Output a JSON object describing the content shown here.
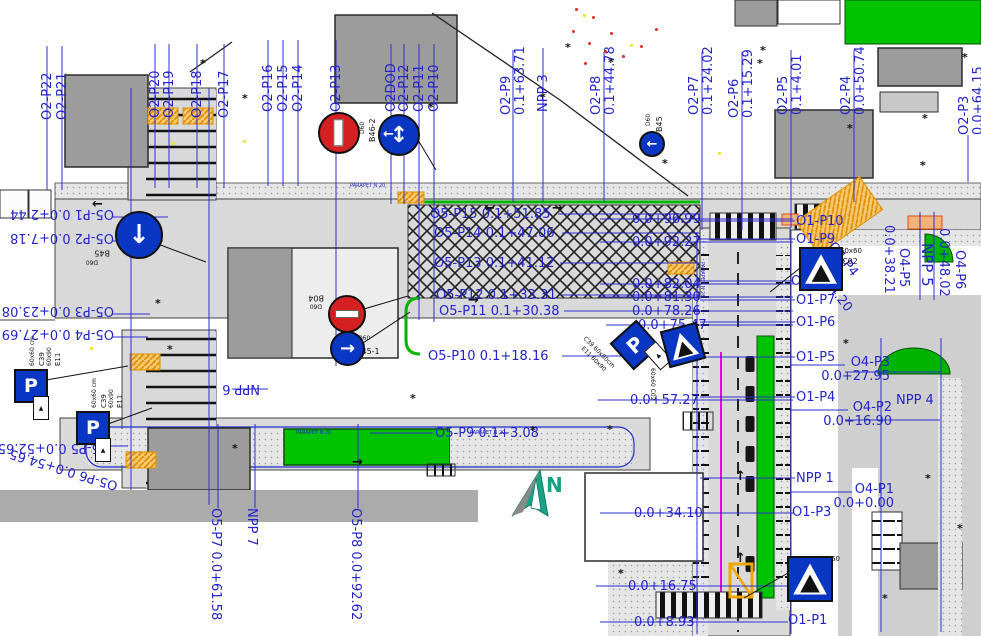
{
  "drawing": {
    "type": "traffic-organization-plan"
  },
  "north": {
    "label": "N"
  },
  "palette": {
    "label_blue": "#2424cc",
    "dimension_blue": "#2f2fd0",
    "green": "#00c300",
    "road_gray": "#d9d9d9",
    "orange": "#f0a000",
    "magenta": "#e800e8",
    "sign_blue": "#0a36c4",
    "sign_red": "#d42020"
  },
  "station_labels": [
    {
      "t": "O2-P22",
      "x": 41,
      "y": 120,
      "r": -90
    },
    {
      "t": "O2-P21",
      "x": 56,
      "y": 120,
      "r": -90
    },
    {
      "t": "O2-P20",
      "x": 149,
      "y": 118,
      "r": -90
    },
    {
      "t": "O2-P19",
      "x": 163,
      "y": 118,
      "r": -90
    },
    {
      "t": "O2-P18",
      "x": 191,
      "y": 118,
      "r": -90
    },
    {
      "t": "O2-P17",
      "x": 218,
      "y": 118,
      "r": -90
    },
    {
      "t": "O2-P16",
      "x": 262,
      "y": 112,
      "r": -90
    },
    {
      "t": "O2-P15",
      "x": 277,
      "y": 112,
      "r": -90
    },
    {
      "t": "O2-P14",
      "x": 292,
      "y": 112,
      "r": -90
    },
    {
      "t": "O2-P13",
      "x": 330,
      "y": 112,
      "r": -90
    },
    {
      "t": "O2DOD",
      "x": 385,
      "y": 112,
      "r": -90
    },
    {
      "t": "O2-P12",
      "x": 398,
      "y": 112,
      "r": -90
    },
    {
      "t": "O2-P11",
      "x": 413,
      "y": 112,
      "r": -90
    },
    {
      "t": "O2-P10",
      "x": 428,
      "y": 112,
      "r": -90
    },
    {
      "t": "O2-P9\n0.1+63.71",
      "x": 500,
      "y": 115,
      "r": -90
    },
    {
      "t": "NPP 3",
      "x": 537,
      "y": 112,
      "r": -90
    },
    {
      "t": "O2-P8\n0.1+44.78",
      "x": 590,
      "y": 115,
      "r": -90
    },
    {
      "t": "O2-P7\n0.1+24.02",
      "x": 688,
      "y": 115,
      "r": -90
    },
    {
      "t": "O2-P6\n0.1+15.29",
      "x": 728,
      "y": 118,
      "r": -90
    },
    {
      "t": "O2-P5\n0.1+4.01",
      "x": 777,
      "y": 115,
      "r": -90
    },
    {
      "t": "O2-P4\n0.0+50.74",
      "x": 840,
      "y": 115,
      "r": -90
    },
    {
      "t": "O2-P3\n0.0+64.15",
      "x": 958,
      "y": 135,
      "r": -90
    },
    {
      "t": "O5-P1 0.0+2.44",
      "x": 2,
      "y": 206,
      "r": 180,
      "w": 112
    },
    {
      "t": "O5-P2 0.0+7.18",
      "x": 2,
      "y": 230,
      "r": 180,
      "w": 112
    },
    {
      "t": "O5-P3 0.0+23.08",
      "x": 2,
      "y": 303,
      "r": 180,
      "w": 112
    },
    {
      "t": "O5-P4 0.0+27.69",
      "x": 2,
      "y": 326,
      "r": 180,
      "w": 112
    },
    {
      "t": "O5-P5 0.0+52.65",
      "x": 0,
      "y": 440,
      "r": 180,
      "w": 110
    },
    {
      "t": "O5-P6 0.0+54.65",
      "x": 8,
      "y": 462,
      "r": 197,
      "w": 112
    },
    {
      "t": "O5-P15 0.1+51.85",
      "x": 430,
      "y": 208
    },
    {
      "t": "O5-P14 0.1+47.06",
      "x": 434,
      "y": 227
    },
    {
      "t": "O5-P13 0.1+41.12",
      "x": 434,
      "y": 257
    },
    {
      "t": "O5-P12 0.1+33.31",
      "x": 436,
      "y": 289
    },
    {
      "t": "O5-P11 0.1+30.38",
      "x": 439,
      "y": 305
    },
    {
      "t": "O5-P10 0.1+18.16",
      "x": 428,
      "y": 350
    },
    {
      "t": "O5-P9 0.1+3.08",
      "x": 435,
      "y": 427
    },
    {
      "t": "0.0+96.99",
      "x": 632,
      "y": 213
    },
    {
      "t": "0.0+92.27",
      "x": 632,
      "y": 236
    },
    {
      "t": "0.0+82.04",
      "x": 632,
      "y": 278
    },
    {
      "t": "0.0+81.30",
      "x": 632,
      "y": 291
    },
    {
      "t": "0.0+78.26",
      "x": 632,
      "y": 305
    },
    {
      "t": "0.0+75.47",
      "x": 638,
      "y": 319
    },
    {
      "t": "0.0+57.27",
      "x": 630,
      "y": 394
    },
    {
      "t": "0.0+34.10",
      "x": 634,
      "y": 507
    },
    {
      "t": "0.0+16.75",
      "x": 628,
      "y": 580
    },
    {
      "t": "0.0+8.93",
      "x": 634,
      "y": 616
    },
    {
      "t": "O1-P10",
      "x": 796,
      "y": 215
    },
    {
      "t": "O1-P9",
      "x": 796,
      "y": 233
    },
    {
      "t": "O1-P8",
      "x": 791,
      "y": 275
    },
    {
      "t": "O1-P7",
      "x": 796,
      "y": 294
    },
    {
      "t": "O1-P6",
      "x": 796,
      "y": 316
    },
    {
      "t": "O1-P5",
      "x": 796,
      "y": 351
    },
    {
      "t": "O1-P4",
      "x": 796,
      "y": 391
    },
    {
      "t": "O4-P2\n0.0+16.90",
      "x": 800,
      "y": 401,
      "w": 92,
      "c": "r"
    },
    {
      "t": "NPP 1",
      "x": 796,
      "y": 472
    },
    {
      "t": "O4-P1\n0.0+0.00",
      "x": 808,
      "y": 483,
      "w": 86,
      "c": "r"
    },
    {
      "t": "O1-P3",
      "x": 792,
      "y": 506
    },
    {
      "t": "O1-P2",
      "x": 790,
      "y": 579
    },
    {
      "t": "O1-P1",
      "x": 788,
      "y": 614
    },
    {
      "t": "O4-P3\n0.0+27.95",
      "x": 798,
      "y": 356,
      "w": 92,
      "c": "r"
    },
    {
      "t": "NPP 4",
      "x": 896,
      "y": 394
    },
    {
      "t": "NPP 6",
      "x": 210,
      "y": 381,
      "r": 180,
      "w": 50
    },
    {
      "t": "O5-P7 0.0+61.58",
      "x": 222,
      "y": 508,
      "r": 90
    },
    {
      "t": "NPP 7",
      "x": 258,
      "y": 508,
      "r": 90
    },
    {
      "t": "O5-P8 0.0+92.62",
      "x": 362,
      "y": 508,
      "r": 90
    },
    {
      "t": "0.0+38.21",
      "x": 895,
      "y": 225,
      "r": 90
    },
    {
      "t": "O4-P5",
      "x": 910,
      "y": 248,
      "r": 90
    },
    {
      "t": "NPP 5",
      "x": 934,
      "y": 243,
      "r": 90,
      "s": 15
    },
    {
      "t": "0.0+48.02",
      "x": 950,
      "y": 228,
      "r": 90
    },
    {
      "t": "O4-P6",
      "x": 966,
      "y": 250,
      "r": 90
    },
    {
      "t": "O4-P4",
      "x": 836,
      "y": 240,
      "r": 52
    },
    {
      "t": "0.0+34.20",
      "x": 812,
      "y": 252,
      "r": 52
    }
  ],
  "micro_labels": [
    {
      "t": "B46-2",
      "x": 369,
      "y": 142,
      "r": -90,
      "s": 8,
      "c": "k"
    },
    {
      "t": "D60",
      "x": 360,
      "y": 134,
      "r": -90,
      "s": 6,
      "c": "k"
    },
    {
      "t": "D60",
      "x": 646,
      "y": 126,
      "r": -90,
      "s": 6,
      "c": "k"
    },
    {
      "t": "B45",
      "x": 656,
      "y": 132,
      "r": -90,
      "s": 8,
      "c": "k"
    },
    {
      "t": "B04",
      "x": 304,
      "y": 293,
      "r": 180,
      "s": 8,
      "c": "k",
      "w": 20
    },
    {
      "t": "D60",
      "x": 306,
      "y": 302,
      "r": 180,
      "s": 6,
      "c": "k",
      "w": 16
    },
    {
      "t": "D60",
      "x": 358,
      "y": 336,
      "s": 6,
      "c": "k"
    },
    {
      "t": "B45-1",
      "x": 356,
      "y": 348,
      "s": 8,
      "c": "k"
    },
    {
      "t": "B45",
      "x": 90,
      "y": 248,
      "r": 180,
      "s": 8,
      "c": "k",
      "w": 20
    },
    {
      "t": "D60",
      "x": 82,
      "y": 258,
      "r": 180,
      "s": 6,
      "c": "k",
      "w": 16
    },
    {
      "t": "60x60 cm",
      "x": 30,
      "y": 366,
      "r": -90,
      "s": 6,
      "c": "k"
    },
    {
      "t": "C39",
      "x": 39,
      "y": 366,
      "r": -90,
      "s": 7,
      "c": "k"
    },
    {
      "t": "60x90",
      "x": 47,
      "y": 366,
      "r": -90,
      "s": 6,
      "c": "k"
    },
    {
      "t": "E11",
      "x": 55,
      "y": 366,
      "r": -90,
      "s": 7,
      "c": "k"
    },
    {
      "t": "60x60 cm",
      "x": 92,
      "y": 408,
      "r": -90,
      "s": 6,
      "c": "k"
    },
    {
      "t": "C39",
      "x": 101,
      "y": 408,
      "r": -90,
      "s": 7,
      "c": "k"
    },
    {
      "t": "60x90",
      "x": 109,
      "y": 408,
      "r": -90,
      "s": 6,
      "c": "k"
    },
    {
      "t": "E11",
      "x": 117,
      "y": 408,
      "r": -90,
      "s": 7,
      "c": "k"
    },
    {
      "t": "C39 60x60cm",
      "x": 586,
      "y": 336,
      "r": 45,
      "s": 6,
      "c": "k"
    },
    {
      "t": "E11 60x90",
      "x": 584,
      "y": 346,
      "r": 45,
      "s": 6,
      "c": "k"
    },
    {
      "t": "60x60",
      "x": 840,
      "y": 248,
      "s": 7,
      "c": "k"
    },
    {
      "t": "C02",
      "x": 842,
      "y": 258,
      "s": 8,
      "c": "k"
    },
    {
      "t": "60x60",
      "x": 818,
      "y": 556,
      "s": 7,
      "c": "k"
    },
    {
      "t": "C02",
      "x": 818,
      "y": 566,
      "s": 8,
      "c": "k"
    },
    {
      "t": "60x60 C02",
      "x": 655,
      "y": 368,
      "r": 90,
      "s": 6,
      "c": "k"
    },
    {
      "t": "PARAPET N 20",
      "x": 350,
      "y": 184,
      "s": 5,
      "c": "m"
    },
    {
      "t": "PARAPET N 20",
      "x": 296,
      "y": 431,
      "s": 5,
      "c": "m"
    },
    {
      "t": "PARAPET N 20",
      "x": 470,
      "y": 431,
      "s": 5,
      "c": "m"
    },
    {
      "t": "PARAPET N 26",
      "x": 704,
      "y": 262,
      "r": 90,
      "s": 5,
      "c": "m"
    }
  ],
  "road_markings": {
    "arrows": [
      {
        "t": "←",
        "x": 92,
        "y": 198
      },
      {
        "t": "←",
        "x": 484,
        "y": 202
      },
      {
        "t": "→",
        "x": 552,
        "y": 202
      },
      {
        "t": "→",
        "x": 468,
        "y": 294
      },
      {
        "t": "→",
        "x": 352,
        "y": 456
      },
      {
        "t": "↑",
        "x": 735,
        "y": 552
      },
      {
        "t": "↑",
        "x": 735,
        "y": 470
      }
    ]
  },
  "signs": [
    {
      "kind": "no-entry",
      "x": 318,
      "y": 112,
      "d": 38,
      "bar": "v",
      "name": "no-entry-sign-b04-top"
    },
    {
      "kind": "arrow-circle",
      "x": 378,
      "y": 114,
      "d": 38,
      "arrow": "updown-left",
      "name": "direction-sign-b46-2"
    },
    {
      "kind": "arrow-circle",
      "x": 115,
      "y": 211,
      "d": 44,
      "arrow": "down",
      "name": "direction-sign-b45-left"
    },
    {
      "kind": "no-entry",
      "x": 328,
      "y": 295,
      "d": 34,
      "bar": "h",
      "name": "no-entry-sign-b04"
    },
    {
      "kind": "arrow-circle",
      "x": 330,
      "y": 331,
      "d": 31,
      "arrow": "right",
      "name": "direction-sign-b45-1"
    },
    {
      "kind": "arrow-circle",
      "x": 639,
      "y": 131,
      "d": 22,
      "arrow": "left",
      "name": "direction-sign-b45-top"
    },
    {
      "kind": "parking",
      "x": 14,
      "y": 369,
      "s": 30,
      "rot": 0,
      "name": "parking-sign-c39-1"
    },
    {
      "kind": "parking",
      "x": 76,
      "y": 411,
      "s": 30,
      "rot": 0,
      "name": "parking-sign-c39-2"
    },
    {
      "kind": "parking",
      "x": 617,
      "y": 327,
      "s": 32,
      "rot": -42,
      "name": "parking-sign-c39-3"
    },
    {
      "kind": "cross",
      "x": 664,
      "y": 326,
      "s": 34,
      "rot": -15,
      "name": "crossing-sign-c02-1"
    },
    {
      "kind": "cross",
      "x": 799,
      "y": 247,
      "s": 40,
      "rot": 0,
      "name": "crossing-sign-c02-2"
    },
    {
      "kind": "cross",
      "x": 787,
      "y": 556,
      "s": 42,
      "rot": 0,
      "name": "crossing-sign-c02-3"
    }
  ],
  "dimension_lines": [
    [
      47,
      46,
      47,
      190
    ],
    [
      62,
      46,
      62,
      190
    ],
    [
      155,
      44,
      155,
      188
    ],
    [
      169,
      44,
      169,
      188
    ],
    [
      197,
      44,
      197,
      188
    ],
    [
      224,
      44,
      224,
      188
    ],
    [
      268,
      40,
      268,
      186
    ],
    [
      283,
      40,
      283,
      186
    ],
    [
      298,
      40,
      298,
      186
    ],
    [
      336,
      40,
      336,
      366
    ],
    [
      391,
      44,
      391,
      204
    ],
    [
      404,
      44,
      404,
      204
    ],
    [
      419,
      44,
      419,
      320
    ],
    [
      434,
      44,
      434,
      322
    ],
    [
      513,
      50,
      513,
      202
    ],
    [
      543,
      48,
      543,
      202
    ],
    [
      604,
      52,
      604,
      202
    ],
    [
      702,
      52,
      702,
      230
    ],
    [
      742,
      52,
      742,
      230
    ],
    [
      791,
      50,
      791,
      228
    ],
    [
      854,
      50,
      854,
      202
    ],
    [
      968,
      135,
      968,
      182
    ],
    [
      131,
      88,
      131,
      490
    ],
    [
      209,
      88,
      209,
      505
    ],
    [
      697,
      232,
      697,
      634
    ],
    [
      791,
      230,
      791,
      634
    ],
    [
      881,
      338,
      881,
      632
    ],
    [
      941,
      338,
      941,
      632
    ],
    [
      920,
      212,
      920,
      300
    ],
    [
      934,
      212,
      934,
      300
    ],
    [
      218,
      424,
      218,
      508
    ],
    [
      255,
      424,
      255,
      508
    ],
    [
      358,
      424,
      358,
      508
    ],
    [
      112,
      217,
      168,
      217
    ],
    [
      112,
      241,
      163,
      241
    ],
    [
      112,
      314,
      150,
      314
    ],
    [
      112,
      337,
      148,
      337
    ],
    [
      108,
      446,
      128,
      446
    ],
    [
      558,
      214,
      700,
      214
    ],
    [
      562,
      233,
      700,
      233
    ],
    [
      560,
      263,
      700,
      263
    ],
    [
      562,
      295,
      700,
      295
    ],
    [
      564,
      311,
      700,
      311
    ],
    [
      562,
      356,
      698,
      356
    ],
    [
      370,
      433,
      433,
      433
    ],
    [
      600,
      219,
      793,
      219
    ],
    [
      600,
      242,
      793,
      242
    ],
    [
      600,
      284,
      793,
      284
    ],
    [
      600,
      297,
      793,
      297
    ],
    [
      600,
      311,
      793,
      311
    ],
    [
      606,
      325,
      793,
      325
    ],
    [
      598,
      400,
      793,
      400
    ],
    [
      600,
      513,
      793,
      513
    ],
    [
      596,
      586,
      790,
      586
    ],
    [
      600,
      622,
      788,
      622
    ],
    [
      700,
      221,
      795,
      221
    ],
    [
      700,
      239,
      795,
      239
    ],
    [
      700,
      281,
      793,
      281
    ],
    [
      700,
      300,
      795,
      300
    ],
    [
      700,
      322,
      795,
      322
    ],
    [
      700,
      357,
      795,
      357
    ],
    [
      700,
      397,
      795,
      397
    ],
    [
      700,
      478,
      795,
      478
    ],
    [
      790,
      410,
      848,
      410
    ],
    [
      790,
      365,
      845,
      365
    ],
    [
      790,
      492,
      852,
      492
    ],
    [
      845,
      372,
      940,
      372
    ],
    [
      845,
      420,
      940,
      420
    ],
    [
      232,
      389,
      268,
      389
    ]
  ],
  "black_leaders": [
    [
      155,
      243,
      206,
      262
    ],
    [
      347,
      314,
      408,
      296
    ],
    [
      360,
      345,
      410,
      312
    ],
    [
      800,
      268,
      770,
      292
    ],
    [
      788,
      573,
      744,
      598
    ],
    [
      46,
      380,
      128,
      366
    ],
    [
      108,
      424,
      152,
      408
    ],
    [
      418,
      140,
      436,
      170
    ]
  ],
  "trees": [
    [
      200,
      58
    ],
    [
      242,
      93
    ],
    [
      428,
      102
    ],
    [
      540,
      92
    ],
    [
      565,
      42
    ],
    [
      608,
      57
    ],
    [
      662,
      158
    ],
    [
      757,
      58
    ],
    [
      847,
      123
    ],
    [
      922,
      113
    ],
    [
      962,
      52
    ],
    [
      155,
      298
    ],
    [
      167,
      344
    ],
    [
      410,
      393
    ],
    [
      607,
      424
    ],
    [
      843,
      338
    ],
    [
      925,
      473
    ],
    [
      957,
      523
    ],
    [
      882,
      593
    ],
    [
      618,
      568
    ],
    [
      232,
      443
    ],
    [
      530,
      425
    ],
    [
      760,
      45
    ],
    [
      920,
      160
    ]
  ],
  "dots": {
    "red": [
      [
        575,
        8
      ],
      [
        592,
        16
      ],
      [
        572,
        30
      ],
      [
        588,
        42
      ],
      [
        604,
        50
      ],
      [
        622,
        55
      ],
      [
        640,
        45
      ],
      [
        655,
        28
      ],
      [
        584,
        62
      ],
      [
        610,
        32
      ]
    ],
    "yellow": [
      [
        583,
        14
      ],
      [
        630,
        44
      ],
      [
        172,
        142
      ],
      [
        718,
        152
      ],
      [
        90,
        347
      ],
      [
        243,
        140
      ]
    ]
  }
}
